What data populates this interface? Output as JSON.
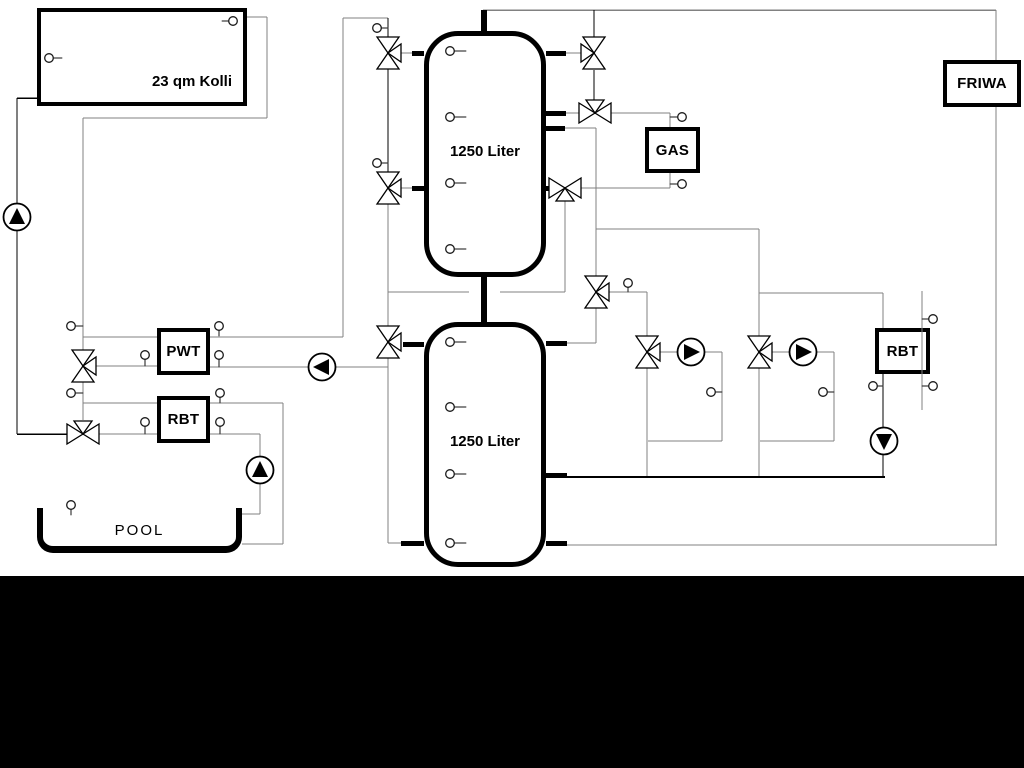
{
  "labels": {
    "collector": "23 qm Kolli",
    "tank_top": "1250 Liter",
    "tank_bottom": "1250 Liter",
    "pwt": "PWT",
    "rbt_left": "RBT",
    "gas": "GAS",
    "friwa": "FRIWA",
    "rbt_right": "RBT",
    "pool": "POOL"
  },
  "colors": {
    "pipe_gray": "#818181",
    "pipe_black": "#000000",
    "background": "#ffffff",
    "bottom_band": "#000000"
  }
}
